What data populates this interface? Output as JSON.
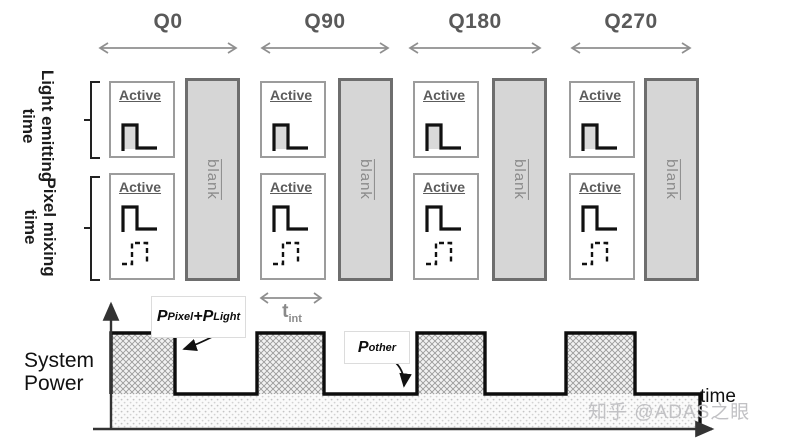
{
  "header": {
    "phases": [
      "Q0",
      "Q90",
      "Q180",
      "Q270"
    ]
  },
  "row_labels": {
    "light_emitting": {
      "line1": "Light emitting",
      "line2": "time"
    },
    "pixel_mixing": {
      "line1": "Pixel mixing",
      "line2": "time"
    }
  },
  "cells": {
    "active": "Active",
    "blank": "blank"
  },
  "power_chart": {
    "axis": {
      "y_line1": "System",
      "y_line2": "Power",
      "x": "time"
    },
    "labels": {
      "p_active": {
        "p1": "P",
        "sub1": "Pixel",
        "plus": "+",
        "p2": "P",
        "sub2": "Light"
      },
      "t_int": {
        "main": "t",
        "sub": "int"
      },
      "p_other": {
        "main": "P",
        "sub": "other"
      }
    },
    "waveform": {
      "pulse_count": 4,
      "high_level_label": "P_Pixel + P_Light",
      "baseline_label": "P_other",
      "pulse_width_label": "t_int"
    }
  },
  "watermark": "知乎 @ADAS之眼",
  "colors": {
    "phase_text": "#595959",
    "arrow_gray": "#8f8f8f",
    "blank_fill": "#d6d6d6",
    "blank_border": "#6e6e6e",
    "active_border": "#9c9c9c",
    "active_text": "#5c5c5c",
    "waveform_stroke": "#111111",
    "watermark_text": "#c1c1c4"
  }
}
